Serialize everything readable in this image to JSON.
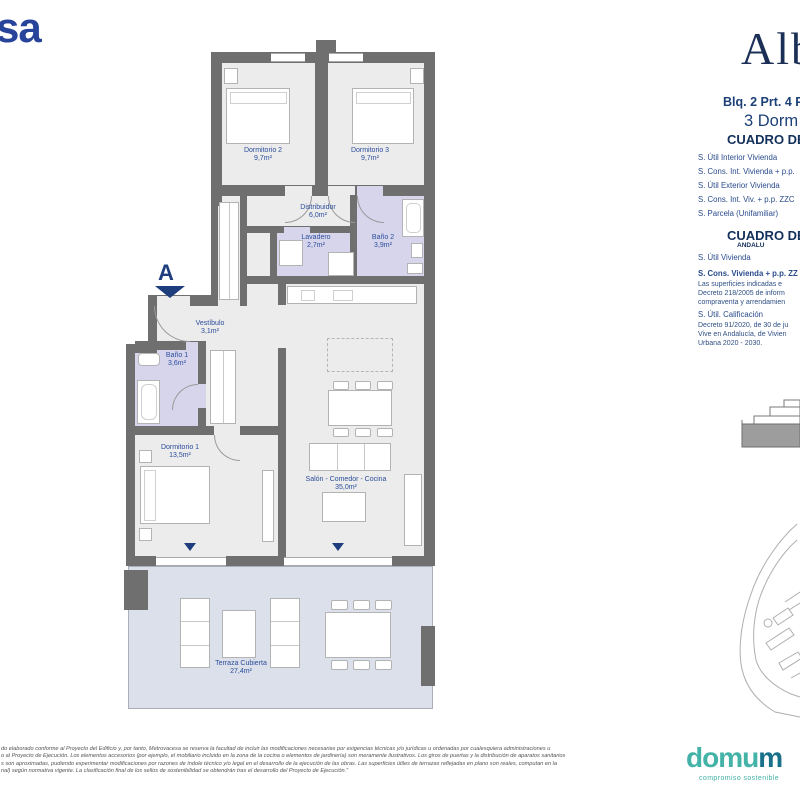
{
  "brand": {
    "metrovacesa_partial": "sa",
    "project_logo_partial": "Alb",
    "block_line": "Blq. 2 Prt. 4 P",
    "type_line": "3 Dorm"
  },
  "surface_tables": {
    "table1": {
      "title": "CUADRO DE",
      "rows": [
        "S. Útil Interior Vivienda",
        "S. Cons. Int. Vivienda + p.p.",
        "S. Útil Exterior Vivienda",
        "S. Cons. Int. Viv. + p.p. ZZC",
        "S. Parcela (Unifamiliar)"
      ]
    },
    "table2": {
      "title": "CUADRO DE",
      "subtitle": "ANDALU",
      "row1": "S. Útil Vivienda",
      "row2": "S. Cons. Vivienda + p.p. ZZ",
      "note1_lines": [
        "Las superficies indicadas e",
        "Decreto 218/2005 de inform",
        "compraventa y arrendamien"
      ],
      "row3": "S. Útil. Calificación",
      "note2_lines": [
        "Decreto 91/2020, de 30 de ju",
        "Vive en Andalucía, de Vivien",
        "Urbana 2020 - 2030."
      ]
    }
  },
  "plan": {
    "entrance_marker": "A",
    "rooms": {
      "dormitorio2": {
        "name": "Dormitorio 2",
        "area": "9,7m²"
      },
      "dormitorio3": {
        "name": "Dormitorio 3",
        "area": "9,7m²"
      },
      "distribuidor": {
        "name": "Distribuidor",
        "area": "6,0m²"
      },
      "lavadero": {
        "name": "Lavadero",
        "area": "2,7m²"
      },
      "bano2": {
        "name": "Baño 2",
        "area": "3,9m²"
      },
      "vestibulo": {
        "name": "Vestíbulo",
        "area": "3,1m²"
      },
      "bano1": {
        "name": "Baño 1",
        "area": "3,6m²"
      },
      "dormitorio1": {
        "name": "Dormitorio 1",
        "area": "13,5m²"
      },
      "salon": {
        "name": "Salón - Comedor - Cocina",
        "area": "35,0m²"
      },
      "terraza": {
        "name": "Terraza Cubierta",
        "area": "27,4m²"
      }
    }
  },
  "footer": {
    "disclaimer_lines": [
      "do elaborado conforme al Proyecto del Edificio y, por tanto, Metrovacesa se reserva la facultad de incluir las modificaciones necesarias por exigencias técnicas y/o jurídicas u ordenadas por cualesquiera administraciones u",
      "o al Proyecto de Ejecución. Los elementos accesorios (por ejemplo, el mobiliario incluido en la zona de la cocina o elementos de jardinería) son meramente ilustrativos. Los giros de puertas y la distribución de aparatos sanitarios",
      "s son aproximadas, pudiendo experimentar modificaciones por razones de índole técnico y/o legal en el desarrollo de la ejecución de las obras. Las superficies útiles de terrazas reflejadas en plano son reales, computan en la",
      "nal) según normativa vigente. La clasificación final de los sellos de sostenibilidad se obtendrán tras el desarrollo del Proyecto de Ejecución.\""
    ],
    "domum_part1": "domu",
    "domum_part2": "m",
    "tagline": "compromiso sostenible"
  },
  "colors": {
    "navy": "#1c3a6b",
    "label_blue": "#2b4d9b",
    "wall_gray": "#6f6f6f",
    "wet_lavender": "#d7d5ec",
    "terrace_blue": "#dbe0ea",
    "metrovacesa_blue": "#27439a",
    "domum_teal": "#43b2a7",
    "domum_dark": "#19708a"
  }
}
